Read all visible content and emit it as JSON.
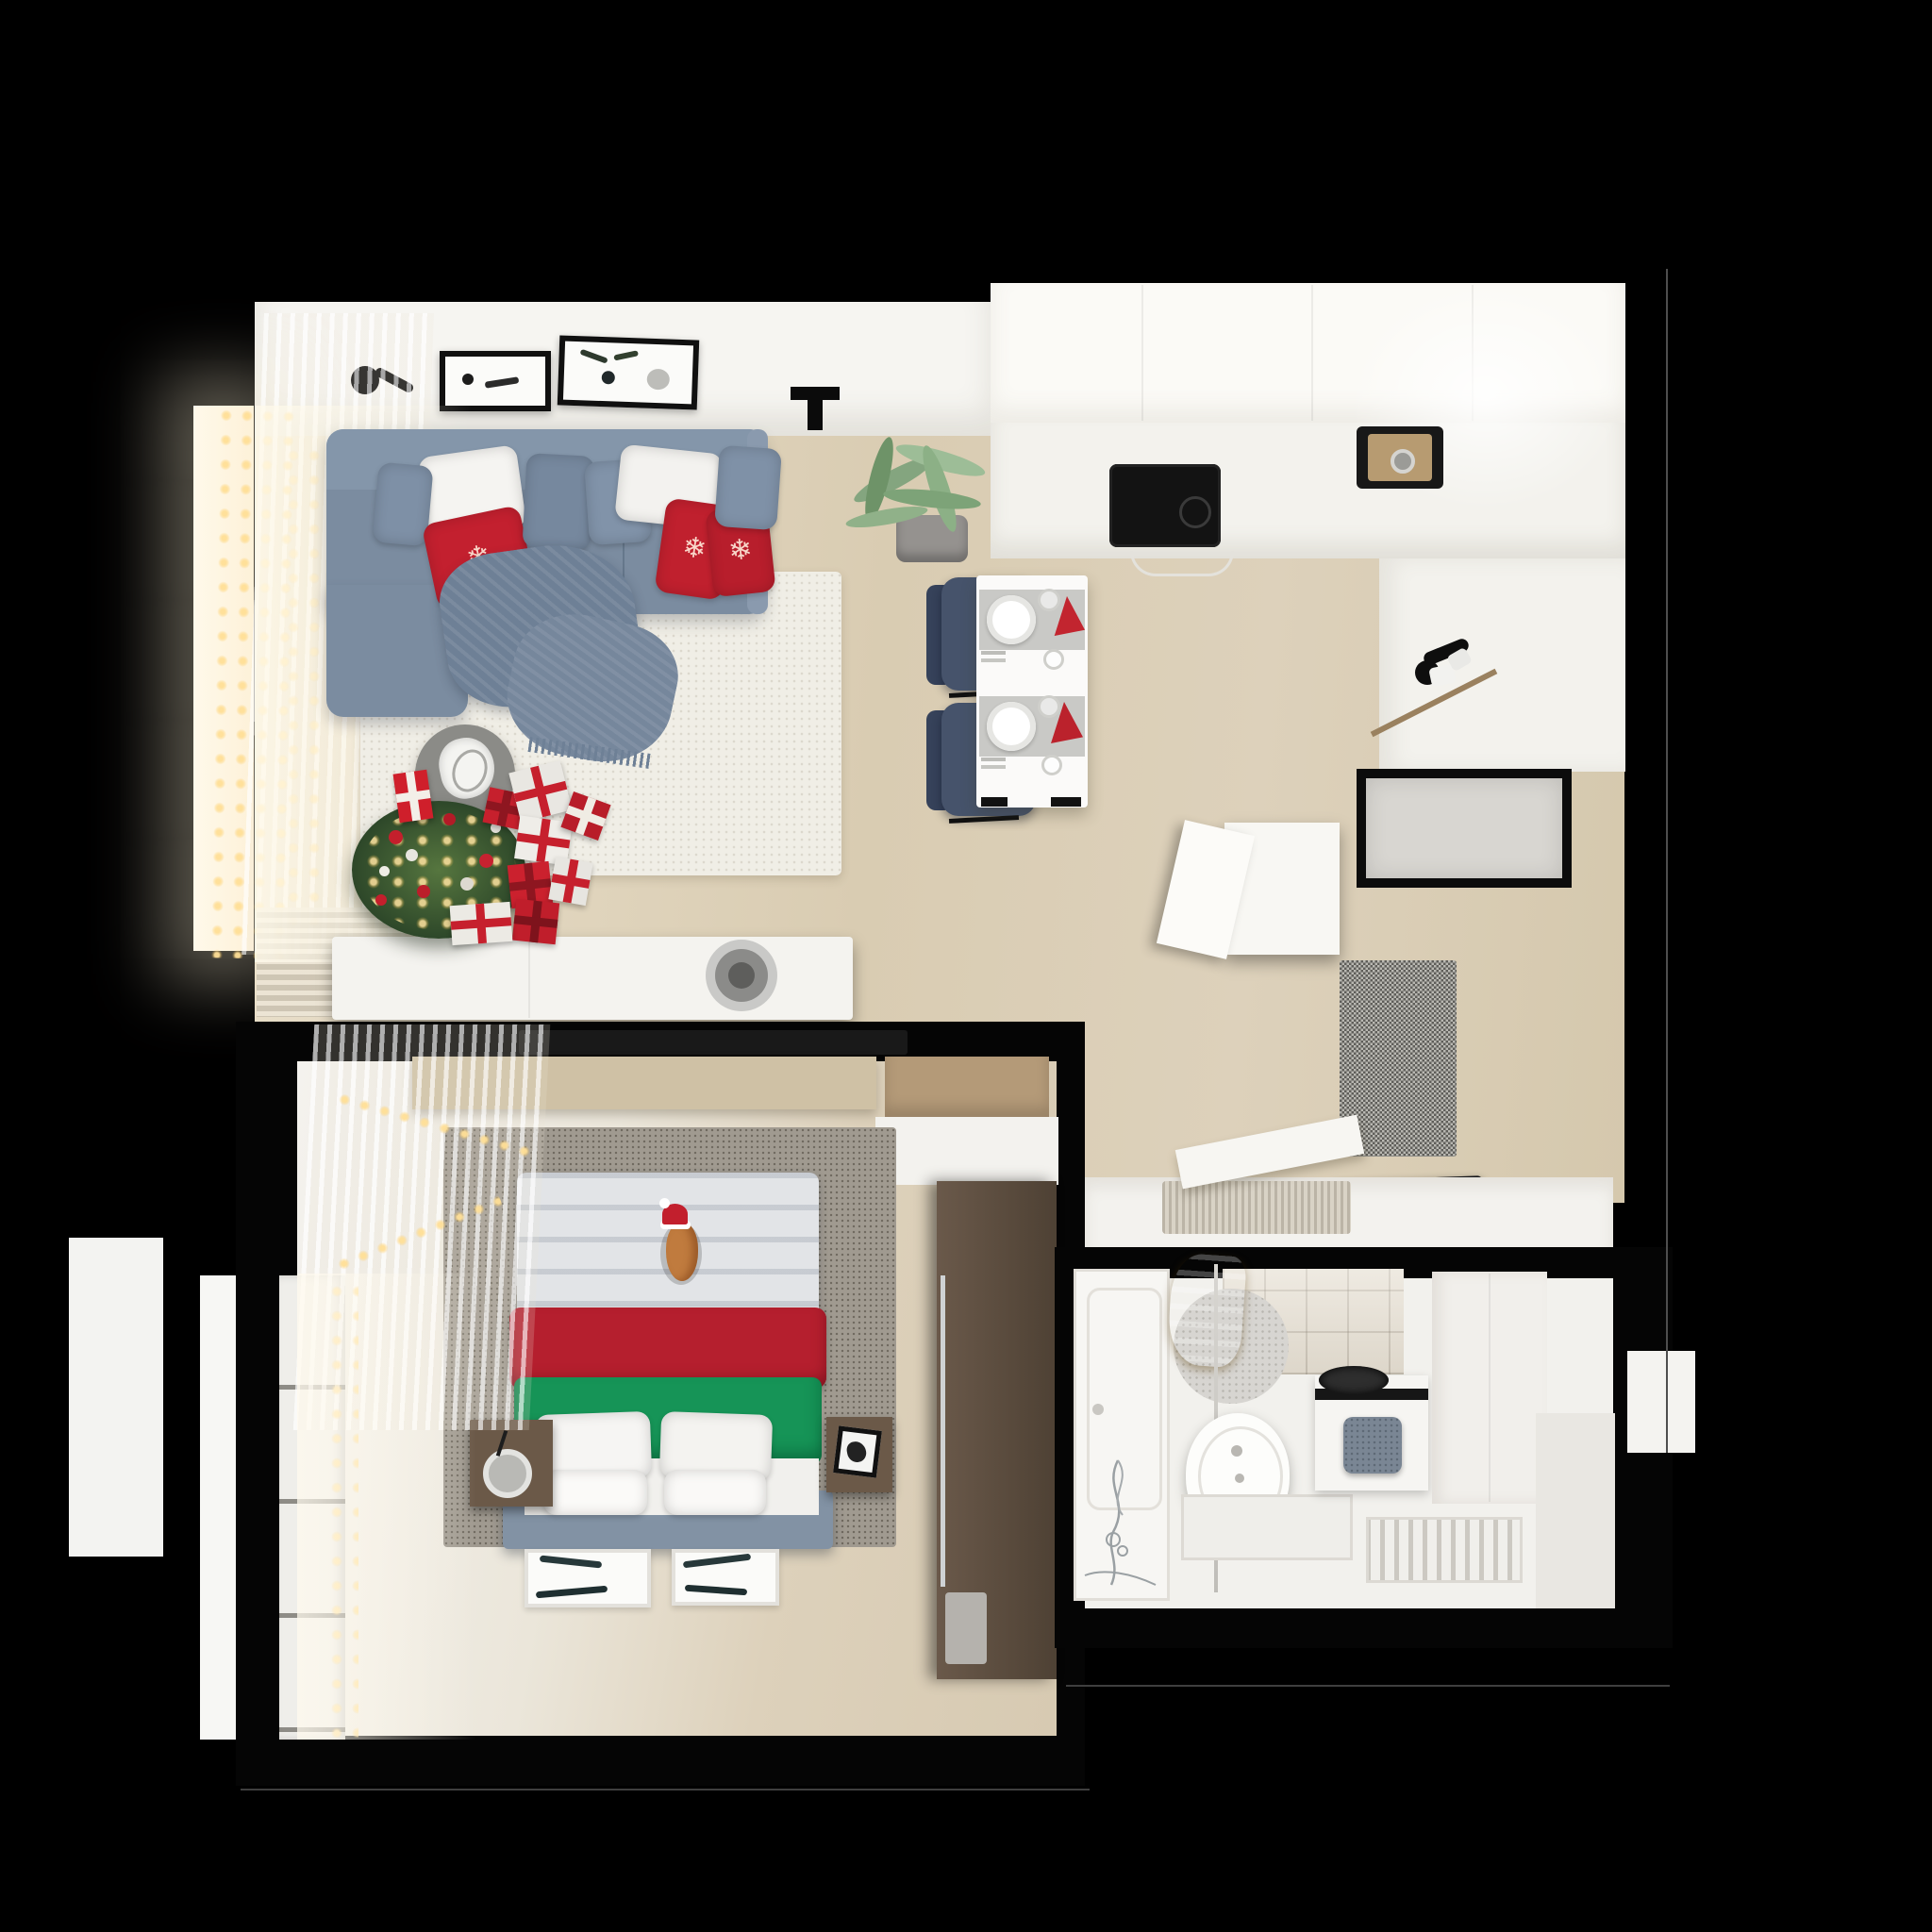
{
  "scene": {
    "label": "Top-down 3D render of a small studio apartment decorated for Christmas",
    "type": "architectural-render-floorplan",
    "background": "#000000",
    "palette": {
      "wall_black": "#070707",
      "floor_beige": "#d9ccb4",
      "floor_light": "#efece5",
      "ceiling_white": "#f7f6f2",
      "cabinet_white": "#f6f5f0",
      "sofa_blue_gray": "#7c8da1",
      "throw_blue": "#6f8197",
      "pillow_white": "#f5f4f1",
      "christmas_red": "#c3202f",
      "blanket_red": "#b51f2e",
      "blanket_green": "#169457",
      "tree_green": "#3f5c33",
      "lights_gold": "#ffd98a",
      "chair_navy": "#424f68",
      "wood_dark": "#5f4f41",
      "wood_light": "#cdbfa3",
      "rug_gray": "#97918a",
      "rug_cream": "#f0eee6",
      "towel_gold": "#d9a520",
      "appliance_black": "#141414",
      "door_panel": "#d9d7d2",
      "doormat_gray": "#8e8d89",
      "bath_white": "#f2f1ed"
    },
    "rooms": [
      {
        "id": "living-room",
        "label": "Living room",
        "items": [
          "corner-sofa",
          "white-pillows",
          "blue-pillows",
          "red-snowflake-pillows",
          "throw-blanket",
          "area-rug",
          "coffee-table",
          "decor-bowl",
          "christmas-tree",
          "string-lights",
          "gift-boxes",
          "sideboard",
          "speaker",
          "wall-art-frames",
          "wall-lamp",
          "ceiling-spot",
          "potted-plant",
          "sheer-curtains",
          "radiator-blinds",
          "window"
        ]
      },
      {
        "id": "kitchen",
        "label": "Kitchen",
        "items": [
          "upper-cabinets",
          "l-shaped-counter",
          "induction-cooktop",
          "sink",
          "black-faucet",
          "dining-table",
          "placemats",
          "dinner-plates",
          "red-napkins",
          "glasses",
          "cutlery",
          "navy-dining-chairs"
        ]
      },
      {
        "id": "hallway",
        "label": "Hallway / entry",
        "items": [
          "entry-door",
          "open-closet",
          "speckled-doormat",
          "shoe-tray",
          "storage-bench",
          "bench-mat",
          "leaning-board"
        ]
      },
      {
        "id": "bedroom",
        "label": "Bedroom",
        "items": [
          "double-bed",
          "red-blanket",
          "green-blanket",
          "bed-pillows",
          "cat-in-santa-hat",
          "gray-rug",
          "nightstands",
          "alarm-clock",
          "wardrobe",
          "desk",
          "wall-shelf",
          "tv",
          "window-garland",
          "sheer-curtains",
          "floor-picture-frames",
          "window"
        ]
      },
      {
        "id": "bathroom",
        "label": "Bathroom",
        "items": [
          "bathtub",
          "glass-partition",
          "gold-towels",
          "round-bath-mat",
          "toilet",
          "shower-tray",
          "slatted-drain-floor",
          "laundry-cabinet",
          "black-basin",
          "gray-towel",
          "mosaic-tile-wall",
          "flower-decal",
          "tall-cabinets"
        ]
      }
    ],
    "counts": {
      "gift_boxes": 9,
      "sofa_pillows": 9,
      "bed_pillows": 4,
      "dining_seats": 2,
      "wall_frames_living": 2,
      "floor_frames_bedroom": 2,
      "placemats": 2
    }
  }
}
